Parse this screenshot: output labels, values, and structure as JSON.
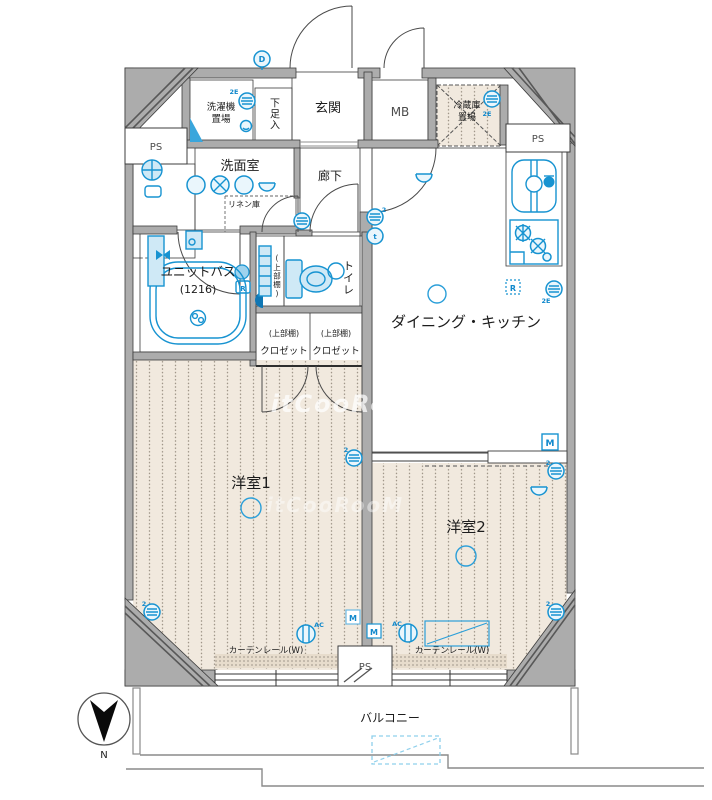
{
  "plan": {
    "watermark": "itCooRooM",
    "compass_north": "N",
    "labels": {
      "entrance": "玄関",
      "shoe_box": "下足入",
      "washing_1": "洗濯機",
      "washing_2": "置場",
      "mb": "MB",
      "fridge_1": "冷蔵庫",
      "fridge_2": "置場",
      "ps": "PS",
      "washroom": "洗面室",
      "linen": "リネン庫",
      "hallway": "廊下",
      "unit_bath": "ユニットバス",
      "unit_bath_size": "(1216)",
      "toilet": "トイレ",
      "upper_shelf": "(上部棚)",
      "closet": "クロゼット",
      "dining_kitchen": "ダイニング・キッチン",
      "room1": "洋室1",
      "room2": "洋室2",
      "balcony": "バルコニー",
      "curtain_rail": "カーテンレール(W)"
    },
    "markers": {
      "intercom": "D",
      "outlet_2e": "2E",
      "outlet_2": "2",
      "tel_t": "t",
      "remote_r": "R",
      "meter_m": "M",
      "ac": "AC"
    },
    "colors": {
      "fixture_blue": "#1793d1",
      "wet_area_blue": "#cfe9f6",
      "storage_pink": "#f8dac6",
      "entrance_cream": "#f8f3d8",
      "floor_beige": "#f1e9de",
      "wall_gray": "#acacac"
    }
  }
}
